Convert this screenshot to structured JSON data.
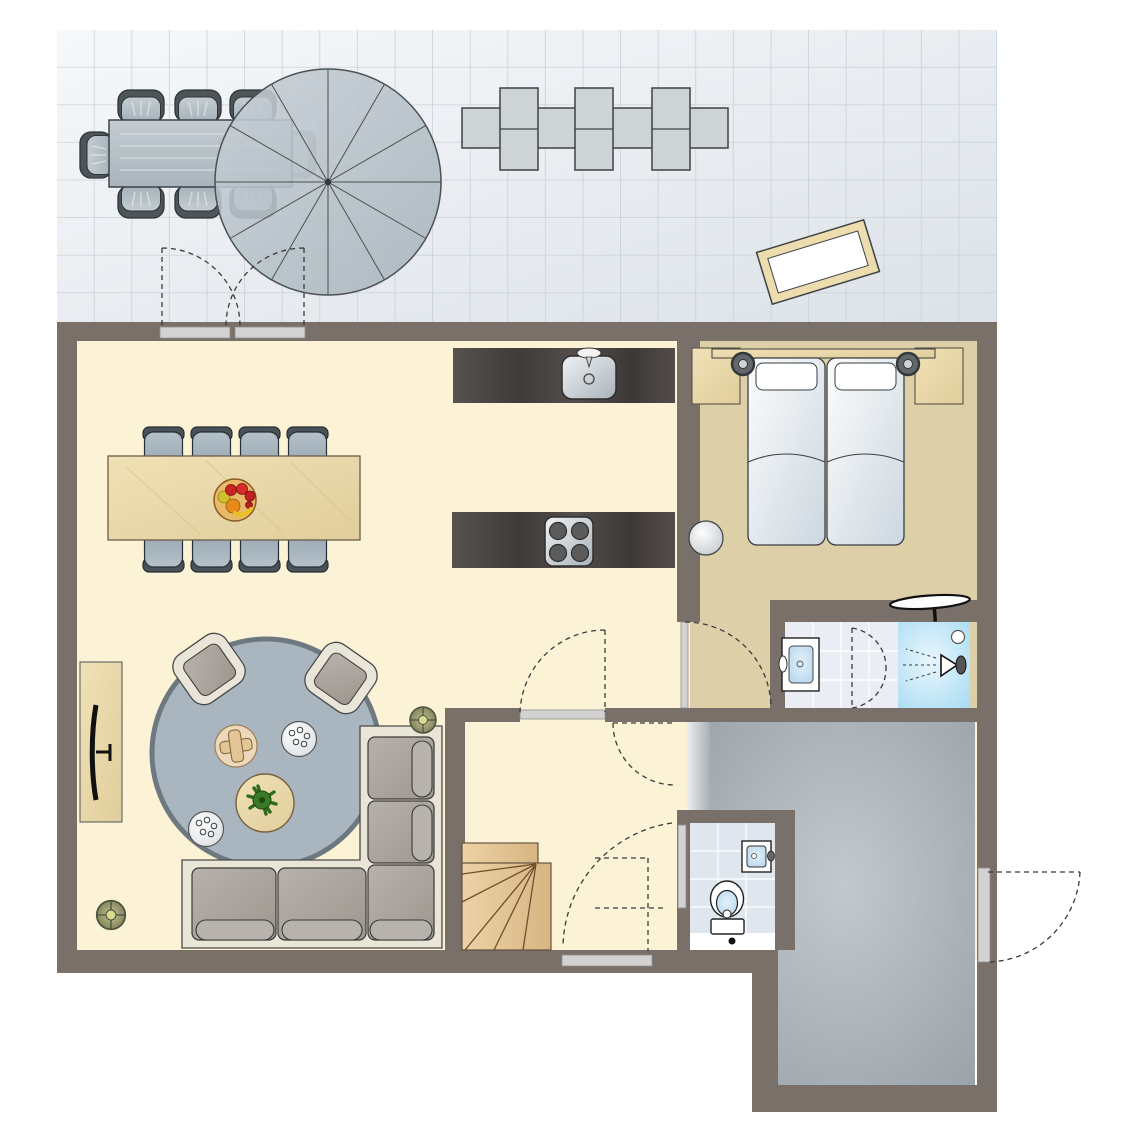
{
  "document": {
    "type": "floor-plan",
    "view": "top-down architectural plan of a holiday home ground floor with terrace",
    "text_labels": []
  },
  "palette": {
    "background": "#ffffff",
    "wall": "#7a706a",
    "terrace_floor": "#eef2f6",
    "terrace_grid": "#c9d1d8",
    "living_floor": "#fcf3d7",
    "bedroom_floor": "#ddd0a8",
    "entrance_floor": "#a2abb2",
    "bathroom_tile": "#eaeef4",
    "toilet_tile": "#dfe6ee",
    "shower_blue": "#bfe2f4",
    "wood_light": "#ead9ad",
    "wood_dark": "#4b4643",
    "stair_wood": "#e2c59c",
    "rug_blue": "#a9b5bf",
    "sofa_frame": "#e9e5d7",
    "cushion_gray": "#aaa49e",
    "chair_blue_gray": "#a7b6c0",
    "door_bar": "#d2d2d2",
    "dash": "#3a3a3a",
    "plant_green": "#2e6b1d",
    "olive": "#9a9a68",
    "mat_tan": "#ecdcae"
  },
  "rooms": [
    {
      "id": "terrace",
      "label": "terrace",
      "furniture": [
        "outdoor dining table",
        "7 outdoor chairs",
        "round parasol",
        "3 sun loungers",
        "doormat",
        "double patio door"
      ]
    },
    {
      "id": "living-dining",
      "label": "living and dining room",
      "furniture": [
        "dining table for 8",
        "fruit bowl",
        "round rug",
        "2 armchairs",
        "corner sofa",
        "coffee table with plant",
        "2 side trays",
        "cross side table",
        "tv cabinet with tv",
        "2 potted plants"
      ]
    },
    {
      "id": "kitchen",
      "label": "open kitchen",
      "furniture": [
        "counter with sink and faucet",
        "counter with 4-burner stove"
      ]
    },
    {
      "id": "bedroom",
      "label": "bedroom",
      "furniture": [
        "double bed with 2 pillows",
        "2 nightstands",
        "2 bedside lamps",
        "headboard",
        "round stool",
        "wall desk"
      ]
    },
    {
      "id": "bathroom",
      "label": "en-suite bathroom",
      "furniture": [
        "vanity sink",
        "walk-in shower with shower head",
        "folding door"
      ]
    },
    {
      "id": "hallway",
      "label": "hallway",
      "furniture": [
        "winder staircase",
        "window"
      ]
    },
    {
      "id": "toilet",
      "label": "toilet room",
      "furniture": [
        "toilet",
        "small hand basin"
      ]
    },
    {
      "id": "entrance-hall",
      "label": "entrance hall",
      "furniture": [
        "front door"
      ]
    }
  ]
}
